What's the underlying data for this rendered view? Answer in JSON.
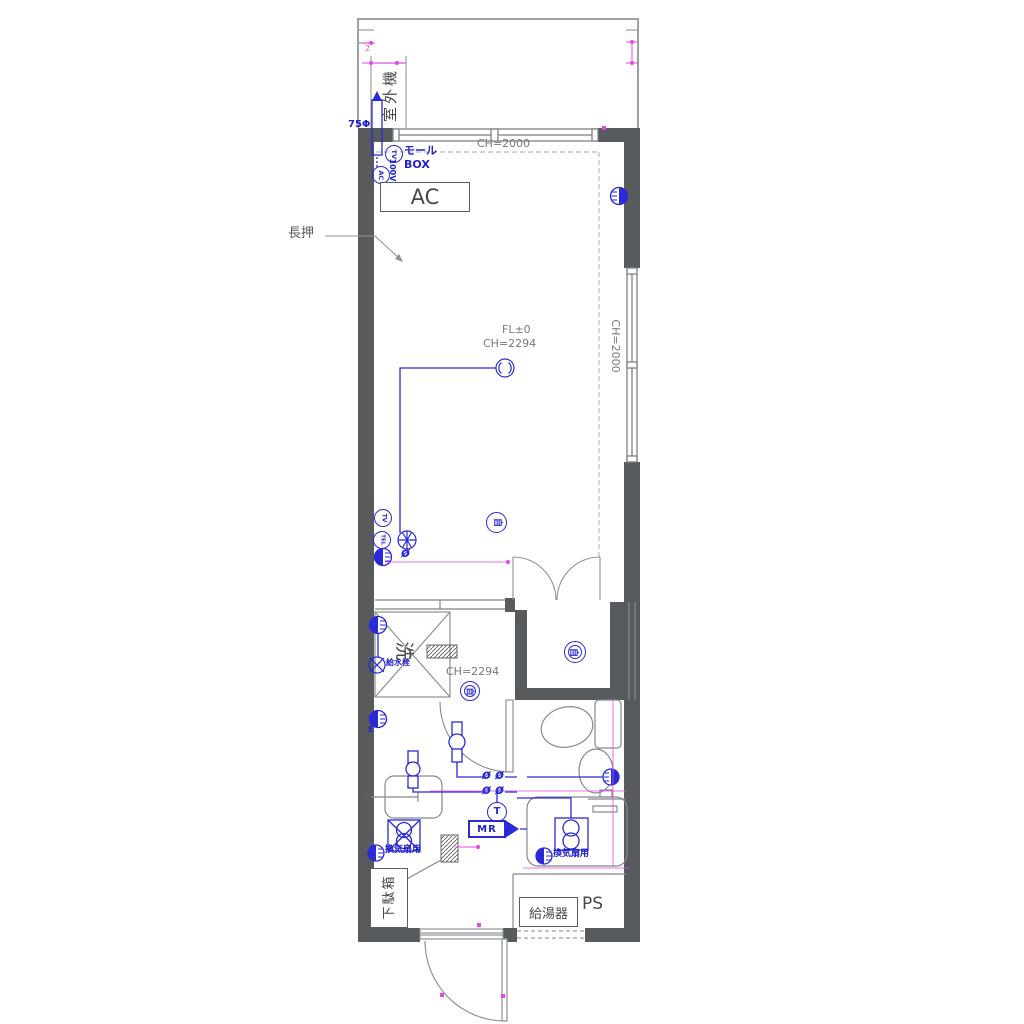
{
  "colors": {
    "wall": "#575b5e",
    "line_gray": "#8b9093",
    "electric_blue": "#2a2ad8",
    "dimension_magenta": "#e549e5",
    "text_gray": "#74797c",
    "text_dark": "#45494c"
  },
  "balcony": {
    "outdoor_unit": "室外機",
    "dim_text": "2",
    "pipe_diameter": "75Φ"
  },
  "wiring_top": {
    "tv": "TV",
    "ac": "AC",
    "mall_line1": "モール",
    "mall_line2": "BOX",
    "voltage": "100V"
  },
  "main_room": {
    "window_top_height": "CH=2000",
    "ac_label": "AC",
    "nageshi_label": "長押",
    "floor_level": "FL±0",
    "ceiling_height": "CH=2294",
    "window_side_height": "CH=2000",
    "tv": "TV",
    "tel": "TEL",
    "phi": "ø",
    "alarm": "自"
  },
  "washroom": {
    "laundry": "洗",
    "water_tap": "給水栓",
    "ceiling_height": "CH=2294",
    "alarm": "自",
    "earth": "E"
  },
  "closet": {
    "alarm": "自"
  },
  "hall": {
    "phi": "ø",
    "terminal": "T",
    "board": "MR"
  },
  "bathroom": {
    "fan_outlet": "換気扇用"
  },
  "kitchen": {
    "fan_outlet": "換気扇用"
  },
  "entrance": {
    "shoe_cabinet": "下駄箱",
    "water_heater": "給湯器",
    "pipe_space": "PS"
  }
}
